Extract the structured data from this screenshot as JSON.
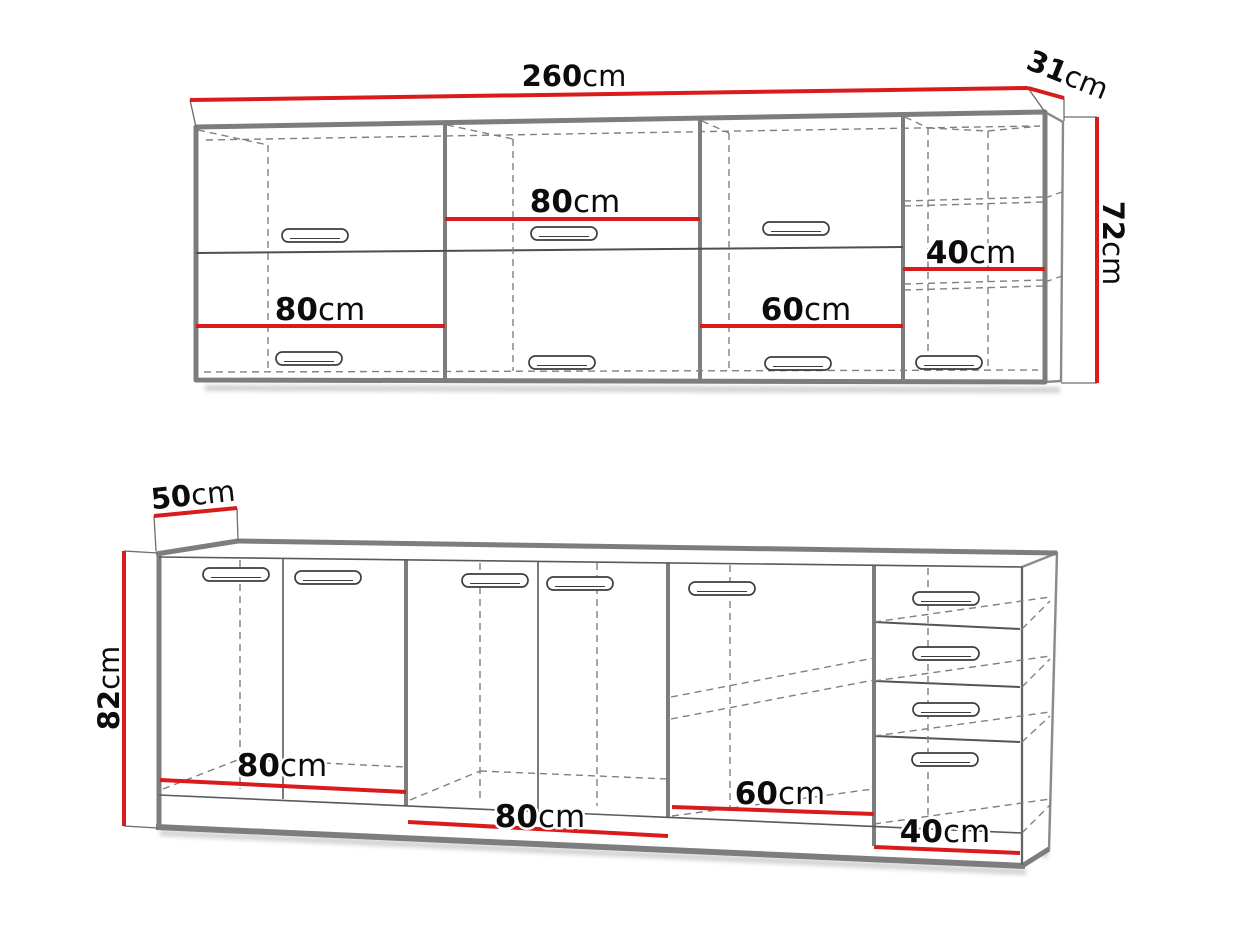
{
  "colors": {
    "dimension_red": "#d81c1c",
    "cabinet_outline_gray": "#7d7d7d",
    "detail_gray": "#5a5a5a",
    "dashed_gray": "#808080",
    "text_black": "#0c0c0c",
    "background": "#ffffff"
  },
  "wall_cabinets": {
    "total_width": {
      "value": "260",
      "unit": "cm"
    },
    "depth": {
      "value": "31",
      "unit": "cm"
    },
    "height": {
      "value": "72",
      "unit": "cm"
    },
    "cabinets": [
      {
        "width": {
          "value": "80",
          "unit": "cm"
        }
      },
      {
        "width": {
          "value": "80",
          "unit": "cm"
        }
      },
      {
        "width": {
          "value": "60",
          "unit": "cm"
        }
      },
      {
        "width": {
          "value": "40",
          "unit": "cm"
        }
      }
    ]
  },
  "base_cabinets": {
    "depth": {
      "value": "50",
      "unit": "cm"
    },
    "height": {
      "value": "82",
      "unit": "cm"
    },
    "cabinets": [
      {
        "width": {
          "value": "80",
          "unit": "cm"
        }
      },
      {
        "width": {
          "value": "80",
          "unit": "cm"
        }
      },
      {
        "width": {
          "value": "60",
          "unit": "cm"
        }
      },
      {
        "width": {
          "value": "40",
          "unit": "cm"
        }
      }
    ]
  }
}
